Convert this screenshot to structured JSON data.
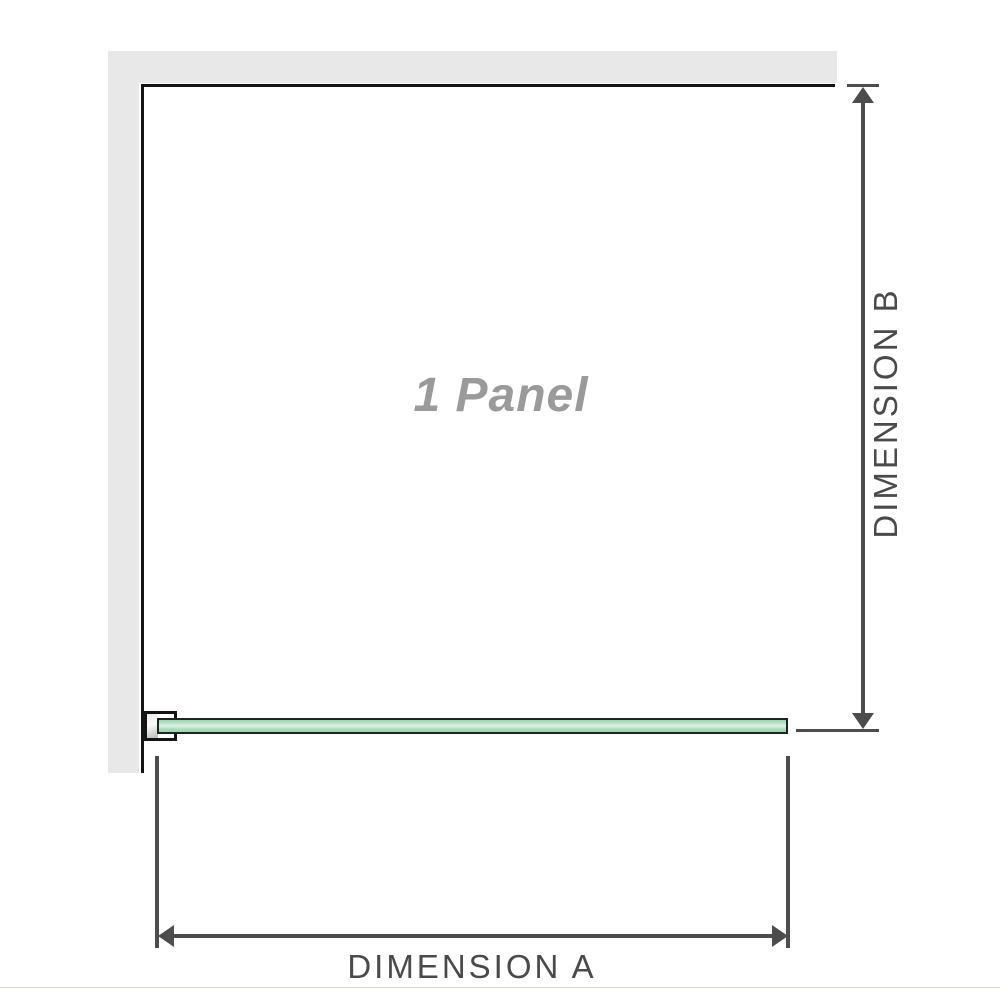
{
  "diagram": {
    "panel_label": "1 Panel",
    "dimension_a_label": "DIMENSION A",
    "dimension_b_label": "DIMENSION B",
    "colors": {
      "glass_green": "#aedcc2",
      "glass_highlight": "#dff2e6",
      "wall_gray": "#e8e8e8",
      "panel_outline": "#141414",
      "dimension_line": "#4d4d4d",
      "dimension_text": "#4a4a4a",
      "panel_label_gray": "#9a9a9a",
      "footer_divider": "#dddbd2"
    }
  }
}
